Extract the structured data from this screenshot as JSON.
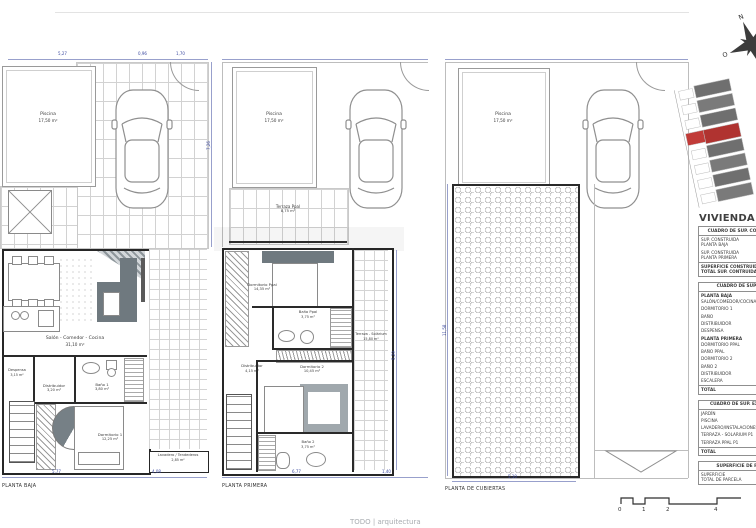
{
  "meta": {
    "logo_text": "TODO | arquitectura"
  },
  "compass": {
    "n": "N",
    "s": "S",
    "e": "E",
    "o": "O"
  },
  "dims": {
    "p1_top_a": "5,27",
    "p1_top_b": "0,96",
    "p1_top_c": "1,70",
    "p1_bottom_a": "5,77",
    "p1_bottom_b": "4,08",
    "p1_side": "7,26",
    "p2_bottom_a": "6,77",
    "p2_bottom_b": "1,40",
    "p2_side": "5,29",
    "p3_side": "11,58",
    "p3_bottom": "5,10"
  },
  "plans": {
    "baja": {
      "caption": "PLANTA BAJA",
      "rooms": {
        "piscina": {
          "name": "Piscina",
          "area": "17,50 m²"
        },
        "salon": {
          "name": "Salón - Comedor - Cocina",
          "area": "31,10 m²"
        },
        "distribuidor": {
          "name": "Distribuidor",
          "area": "3,20 m²"
        },
        "bano1": {
          "name": "Baño 1",
          "area": "3,80 m²"
        },
        "dormitorio1": {
          "name": "Dormitorio 1",
          "area": "12,25 m²"
        },
        "lavadero": {
          "name": "Lavadero / Tendederos",
          "area": "2,85 m²"
        },
        "despensa": {
          "name": "Despensa",
          "area": "3,15 m²"
        }
      }
    },
    "primera": {
      "caption": "PLANTA PRIMERA",
      "rooms": {
        "piscina": {
          "name": "Piscina",
          "area": "17,50 m²"
        },
        "terraza_ppal": {
          "name": "Terraza Ppal",
          "area": "8,75 m²"
        },
        "dormitorio_ppal": {
          "name": "Dormitorio Ppal",
          "area": "14,35 m²"
        },
        "bano_ppal": {
          "name": "Baño Ppal",
          "area": "3,75 m²"
        },
        "distribuidor": {
          "name": "Distribuidor",
          "area": "4,15 m²"
        },
        "dormitorio2": {
          "name": "Dormitorio 2",
          "area": "10,45 m²"
        },
        "bano2": {
          "name": "Baño 2",
          "area": "3,75 m²"
        },
        "terraza_solarium": {
          "name": "Terraza - Solárium",
          "area": "15,80 m²"
        }
      }
    },
    "cubiertas": {
      "caption": "PLANTA DE CUBIERTAS",
      "rooms": {
        "piscina": {
          "name": "Piscina",
          "area": "17,50 m²"
        }
      }
    }
  },
  "sidebar": {
    "title": "VIVIENDA A1",
    "construida": {
      "header": "CUADRO DE SUP. CONSTRUIDAS",
      "rows": [
        {
          "label": "SUP. CONSTRUIDA\nPLANTA BAJA",
          "value": "66,90 m²"
        },
        {
          "label": "SUP. CONSTRUIDA\nPLANTA PRIMERA",
          "value": "45,90 m²"
        },
        {
          "label": "SUPERFICIE CONSTRUIDA\nTOTAL SUP. CONTRUIDA",
          "value": "112,80 m²"
        }
      ]
    },
    "utiles": {
      "header": "CUADRO DE SUP. UTILES",
      "section_baja": "PLANTA BAJA",
      "baja_rows": [
        {
          "label": "SALÓN/COMEDOR/COCINA",
          "value": "31,10 m²"
        },
        {
          "label": "DORMITORIO 1",
          "value": "12,25 m²"
        },
        {
          "label": "BAÑO",
          "value": "3,80 m²"
        },
        {
          "label": "DISTRIBUIDOR",
          "value": "3,20 m²"
        },
        {
          "label": "DESPENSA",
          "value": "3,15 m²"
        }
      ],
      "section_primera": "PLANTA PRIMERA",
      "primera_rows": [
        {
          "label": "DORMITORIO PPAL",
          "value": "14,35 m²"
        },
        {
          "label": "BAÑO PPAL",
          "value": "3,75 m²"
        },
        {
          "label": "DORMITORIO 2",
          "value": "10,45 m²"
        },
        {
          "label": "BAÑO 2",
          "value": "3,75 m²"
        },
        {
          "label": "DISTRIBUIDOR",
          "value": "4,15 m²"
        },
        {
          "label": "ESCALERA",
          "value": "4,25 m²"
        }
      ],
      "total_label": "TOTAL",
      "total_value": "94,20 m²"
    },
    "exteriores": {
      "header": "CUADRO DE SUP. EXTERIORES",
      "rows": [
        {
          "label": "JARDÍN",
          "value": "70,10 m²"
        },
        {
          "label": "PISCINA",
          "value": "17,50 m²"
        },
        {
          "label": "LAVADERO/INSTALACIONES",
          "value": "2,85 m²"
        },
        {
          "label": "TERRAZA - SOLARIUM P1",
          "value": "15,80 m²"
        },
        {
          "label": "TERRAZA PPAL P1",
          "value": "8,75 m²"
        }
      ],
      "total_label": "TOTAL",
      "total_value": "115,00 m²"
    },
    "parcela": {
      "header": "SUPERFICIE DE PARCELA",
      "row_label": "SUPERFICIE\nTOTAL DE PARCELA",
      "row_value": "160,11 m²"
    }
  },
  "scalebar": {
    "ticks": [
      "0",
      "1",
      "2",
      "4"
    ]
  }
}
